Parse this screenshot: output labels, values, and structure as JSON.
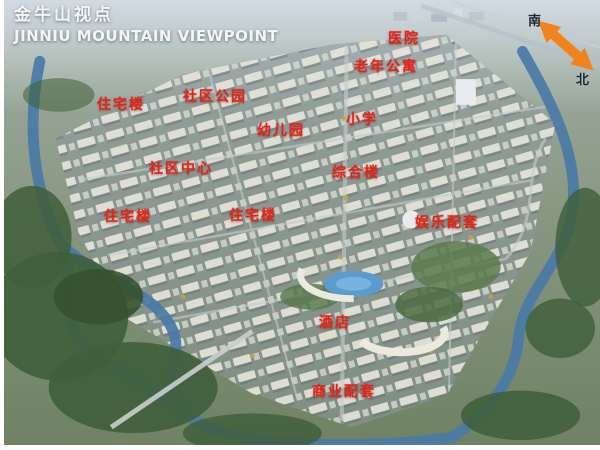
{
  "header": {
    "title_cn": "金牛山视点",
    "title_en": "JINNIU MOUNTAIN VIEWPOINT"
  },
  "compass": {
    "south_label": "南",
    "north_label": "北",
    "arrow_color": "#f0831d"
  },
  "map": {
    "label_color": "#e0251c",
    "labels": [
      {
        "text": "医院",
        "x": 400,
        "y": 38
      },
      {
        "text": "老年公寓",
        "x": 382,
        "y": 66
      },
      {
        "text": "住宅楼",
        "x": 117,
        "y": 104
      },
      {
        "text": "社区公园",
        "x": 211,
        "y": 96
      },
      {
        "text": "幼儿园",
        "x": 277,
        "y": 130
      },
      {
        "text": "小学",
        "x": 358,
        "y": 119
      },
      {
        "text": "社区中心",
        "x": 177,
        "y": 168
      },
      {
        "text": "综合楼",
        "x": 352,
        "y": 172
      },
      {
        "text": "住宅楼",
        "x": 124,
        "y": 216
      },
      {
        "text": "住宅楼",
        "x": 249,
        "y": 215
      },
      {
        "text": "娱乐配套",
        "x": 443,
        "y": 222
      },
      {
        "text": "酒店",
        "x": 331,
        "y": 322
      },
      {
        "text": "商业配套",
        "x": 340,
        "y": 391
      }
    ]
  }
}
